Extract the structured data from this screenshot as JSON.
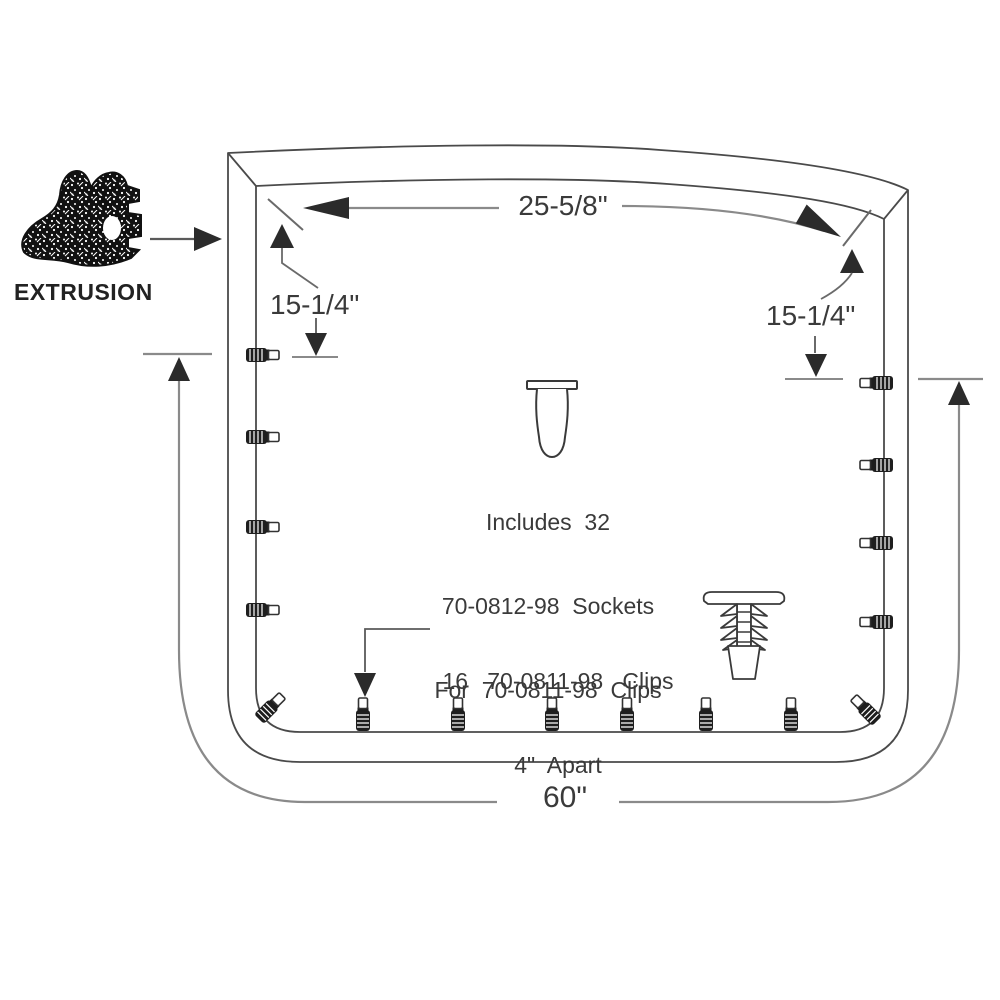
{
  "title": "EXTRUSION",
  "colors": {
    "ink": "#3a3a3a",
    "frame_line": "#4a4a4a",
    "dim_line": "#8a8a8a",
    "arrow_fill": "#2b2b2b",
    "clip_fill": "#1e1e1e"
  },
  "labels": {
    "extrusion": "EXTRUSION",
    "top_width": "25-5/8\"",
    "left_height": "15-1/4\"",
    "right_height": "15-1/4\"",
    "bottom_width": "60\"",
    "sockets_note_line1": "Includes  32",
    "sockets_note_line2": "70-0812-98  Sockets",
    "sockets_note_line3": "For  70-0811-98  Clips",
    "clips_note_line1": "16   70-0811-98   Clips",
    "clips_note_line2": "4\"  Apart"
  },
  "icons": {
    "extrusion_profile": "rubber-extrusion-cross-section-icon",
    "socket": "socket-grommet-icon",
    "tree_clip": "christmas-tree-clip-icon",
    "fastener": "clip-fastener-icon"
  },
  "diagram": {
    "clip_count_text": "16",
    "socket_count_text": "32",
    "left_clips": {
      "cx": 263,
      "ys": [
        355,
        437,
        527,
        610
      ]
    },
    "right_clips": {
      "cx": 876,
      "ys": [
        383,
        465,
        543,
        622
      ]
    },
    "bottom_clips": {
      "cy": 714,
      "xs": [
        363,
        458,
        552,
        627,
        706,
        791
      ]
    },
    "corner_clips": [
      {
        "x": 271,
        "y": 707,
        "deg": -45
      },
      {
        "x": 865,
        "y": 709,
        "deg": -135
      }
    ]
  }
}
